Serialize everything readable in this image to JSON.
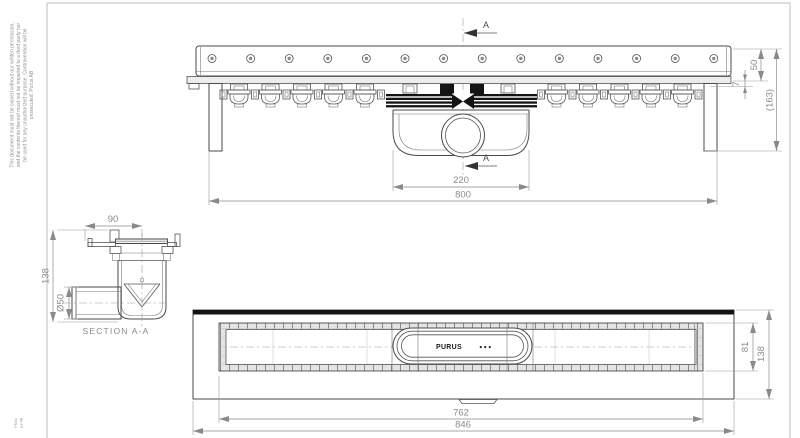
{
  "disclaimer": {
    "line1": "This document must not be copied without our written permission,",
    "line2": "and the contents thereof must not be imparted to a third party nor",
    "line3": "be used for any unauthorized purpose. Contravention will be",
    "line4": "prosecuted. Purus AB"
  },
  "stamp": {
    "line1": "PM46",
    "line2": "pur AB"
  },
  "top_view": {
    "section_label_top": "A",
    "section_label_bottom": "A",
    "dim_housing_width": "220",
    "dim_channel_length": "800",
    "dim_rail_height": "50",
    "dim_offset": "7",
    "dim_total_height": "(163)"
  },
  "section_view": {
    "dim_width": "90",
    "dim_height": "138",
    "dim_pipe_diameter": "Ø50",
    "caption": "SECTION A-A"
  },
  "bottom_view": {
    "dim_inner_length": "762",
    "dim_outer_length": "846",
    "dim_inner_width": "81",
    "dim_outer_width": "138",
    "logo_text": "PURUS",
    "logo_dots": "●●●"
  },
  "colors": {
    "part_line": "#4a4a4a",
    "dimension": "#8a8a8a",
    "seal_black": "#141414",
    "frame": "#bdbdbd"
  }
}
